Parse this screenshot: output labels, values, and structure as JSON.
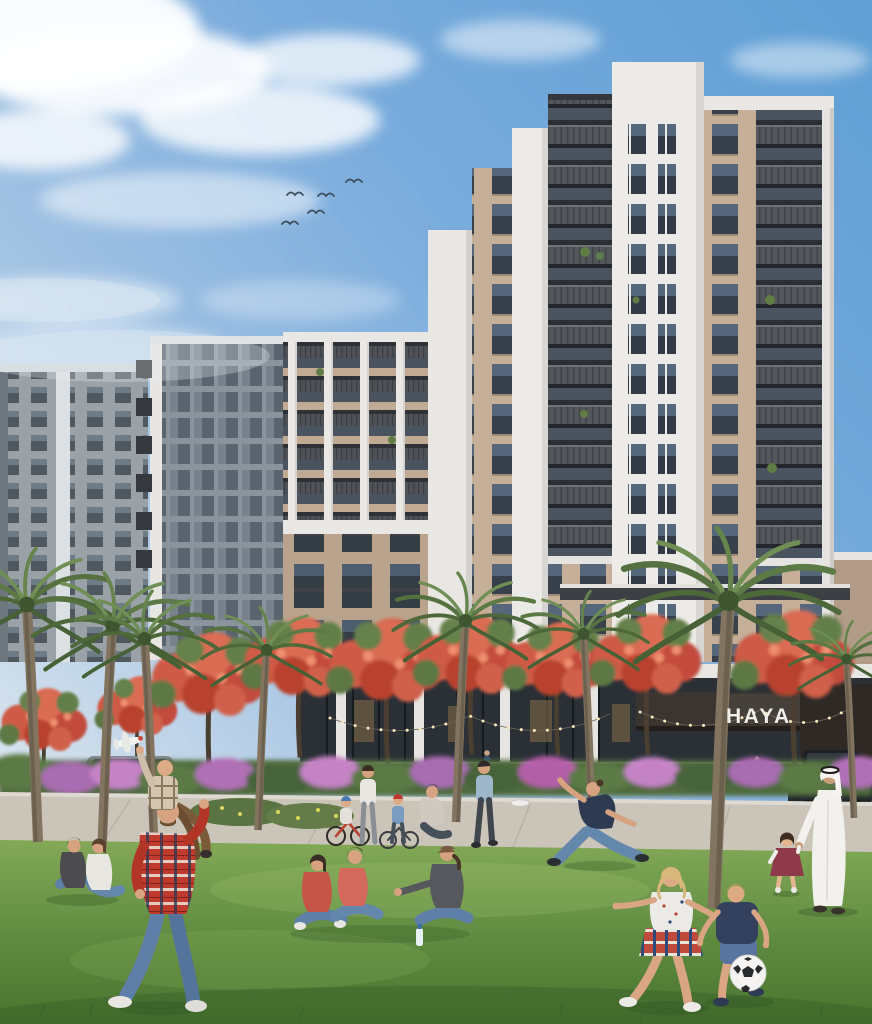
{
  "scene": {
    "kind": "architectural rendering of a residential development",
    "sign_text": "HAYA",
    "buildings": "stepped white and beige apartment towers with dark stacked balconies over a retail podium",
    "foreground": "park lawn with palm trees, red flowering trees, purple bougainvillea hedge and a walkway",
    "people": "father carrying a boy with a toy airplane, two women seated, trio of women chatting, family with bicycles, woman catching a frisbee, girl and boy playing football, man in white kandura walking with a toddler in a maroon dress",
    "vehicles": "silver car at left street, black car at right drive",
    "sky": "blue sky with wispy clouds",
    "bird_count": "5"
  },
  "colors": {
    "sky_top": "#5f9fd4",
    "sky_horizon": "#e6ecf1",
    "facade_white": "#edebe7",
    "facade_beige": "#c5af99",
    "balcony_dark": "#53565b",
    "glass_dark": "#38414b",
    "canopy_dark": "#3b3531",
    "sign_color": "#f0efec",
    "flower_red": "#d25a45",
    "bougainvillea_purple": "#b06fb5",
    "palm_green": "#5f7d45",
    "lawn_green": "#5e8a40",
    "path_gray": "#cbc5ba",
    "plaid_red": "#c03a2e",
    "kandura_white": "#f2f1ee"
  }
}
